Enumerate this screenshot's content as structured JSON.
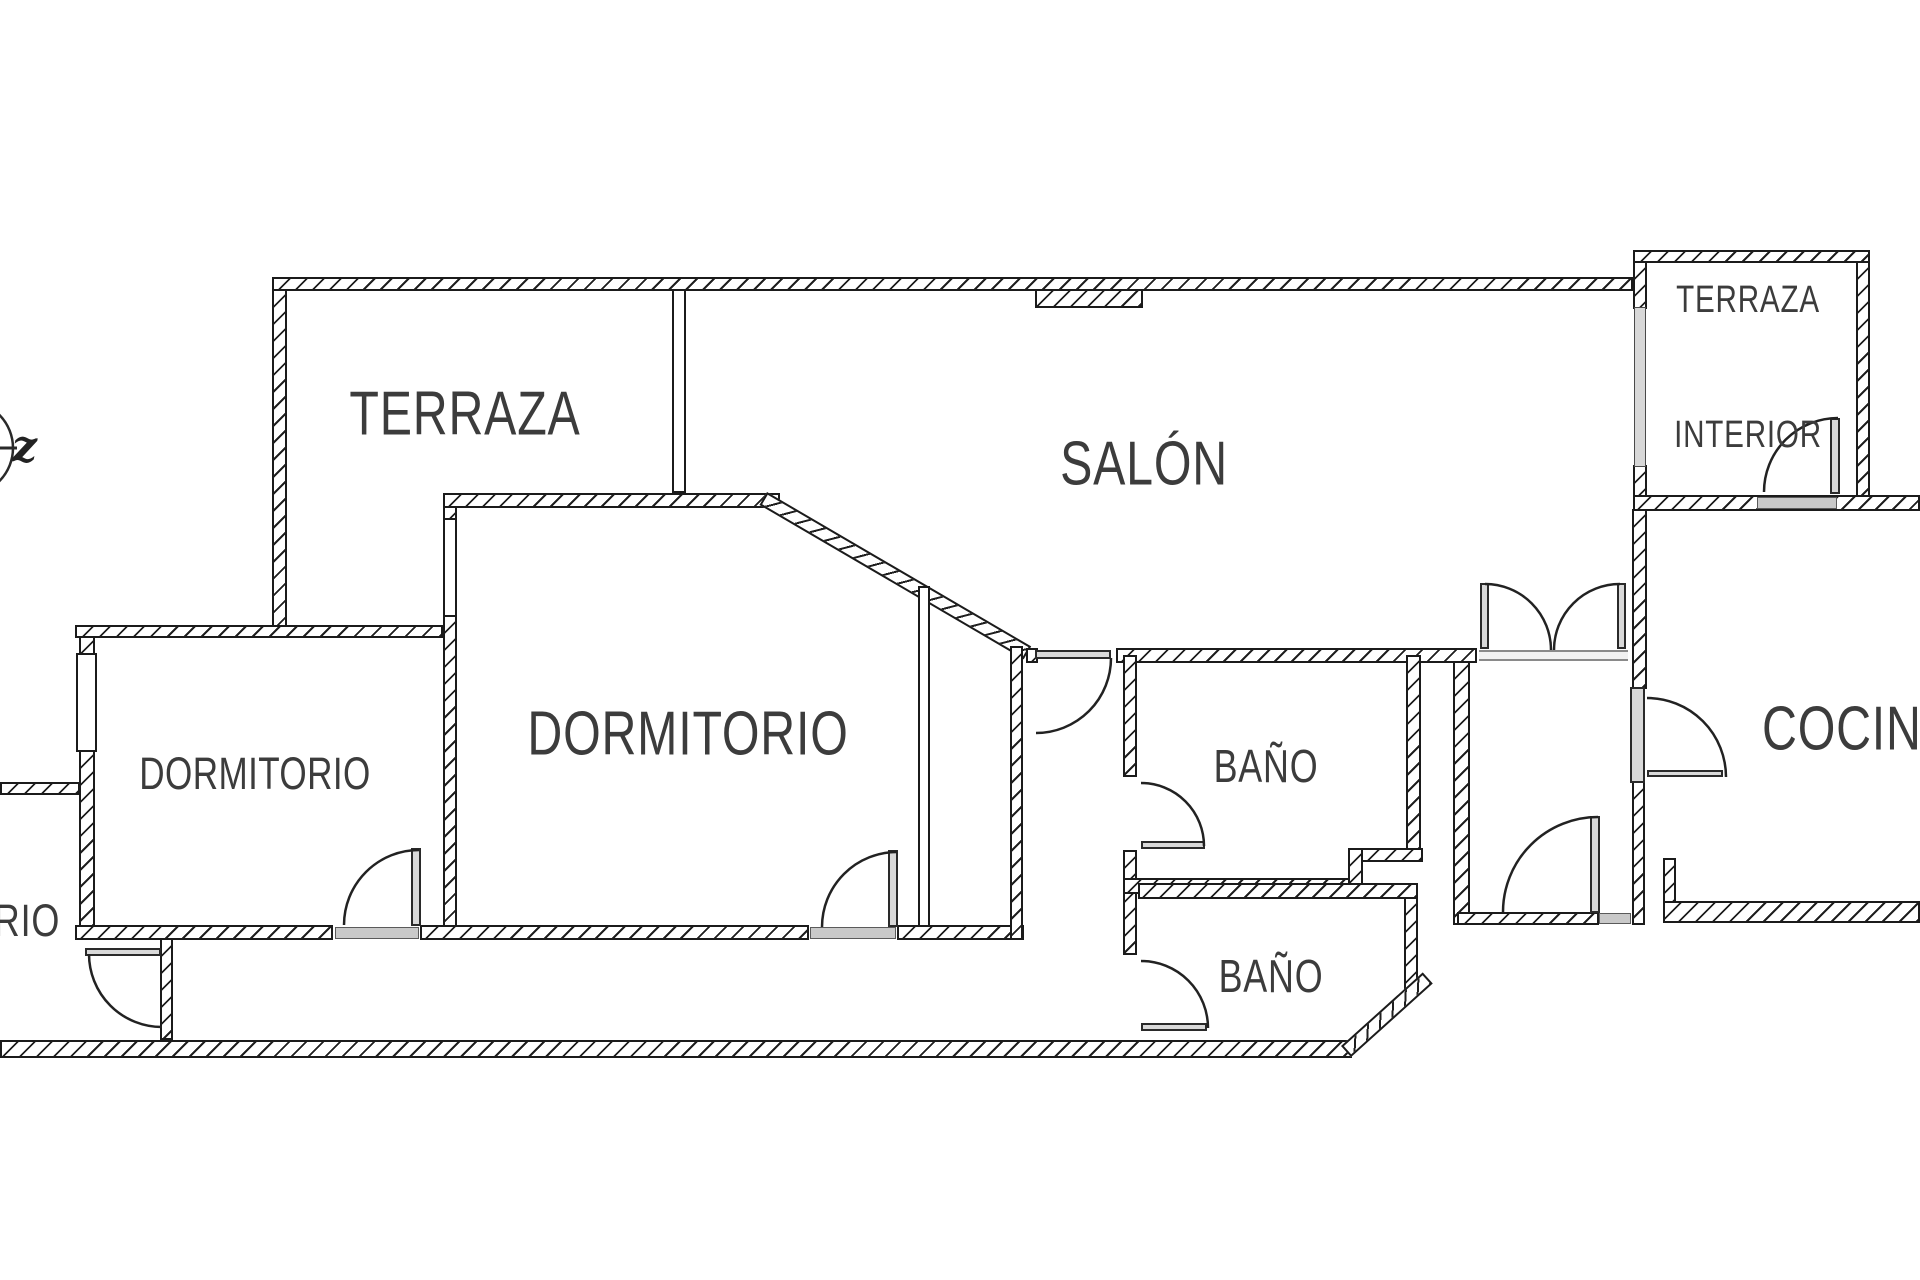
{
  "plan": {
    "title": "floor-plan",
    "colors": {
      "background": "#ffffff",
      "wall_ink": "#1b1b1b",
      "label_text": "#3c3c3c",
      "door_leaf_fill": "#d9d9d9",
      "threshold_fill": "#c9c9c9",
      "glazing_fill": "#d8d8d8"
    }
  },
  "compass": {
    "axis_label": "z"
  },
  "rooms": {
    "terraza": {
      "label": "TERRAZA"
    },
    "salon": {
      "label": "SALÓN"
    },
    "terraza_interior": {
      "line1": "TERRAZA",
      "line2": "INTERIOR"
    },
    "cocina": {
      "label": "COCINA"
    },
    "dormitorio_principal": {
      "label": "DORMITORIO"
    },
    "dormitorio_segundo": {
      "label": "DORMITORIO"
    },
    "bano_superior": {
      "label": "BAÑO"
    },
    "bano_inferior": {
      "label": "BAÑO"
    },
    "dormitorio_recortado": {
      "label": "ORIO"
    }
  }
}
